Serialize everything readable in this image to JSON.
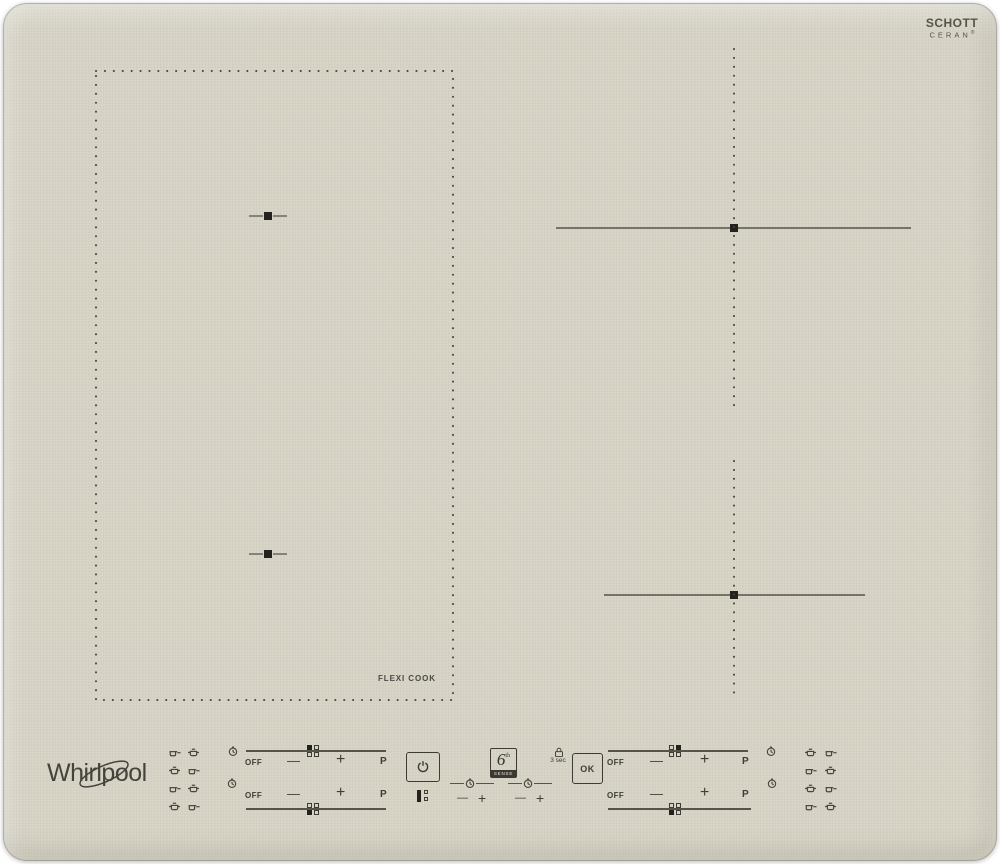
{
  "branding": {
    "whirlpool_logo": "Whirlpool",
    "schott_logo_line1": "SCHOTT",
    "schott_logo_line2": "CERAN",
    "schott_registered": "®"
  },
  "surface": {
    "flexi_zone_label": "FLEXI COOK"
  },
  "control_panel": {
    "slider": {
      "off": "OFF",
      "minus": "—",
      "plus": "+",
      "boost": "P"
    },
    "timer": {
      "minus": "—",
      "plus": "+"
    },
    "six_sense": {
      "digit": "6",
      "superscript": "th",
      "caption": "SENSE"
    },
    "lock": {
      "hold_label": "3 sec",
      "ok_label": "OK"
    }
  },
  "icons": {
    "power": "power-icon",
    "timer_clock": "timer-clock-icon",
    "lock": "lock-icon",
    "pan": "pan-icon",
    "pot": "pot-icon"
  },
  "colors": {
    "glass": "#d6d3c5",
    "ink": "#3e3d35",
    "zone_line": "#55544a"
  }
}
